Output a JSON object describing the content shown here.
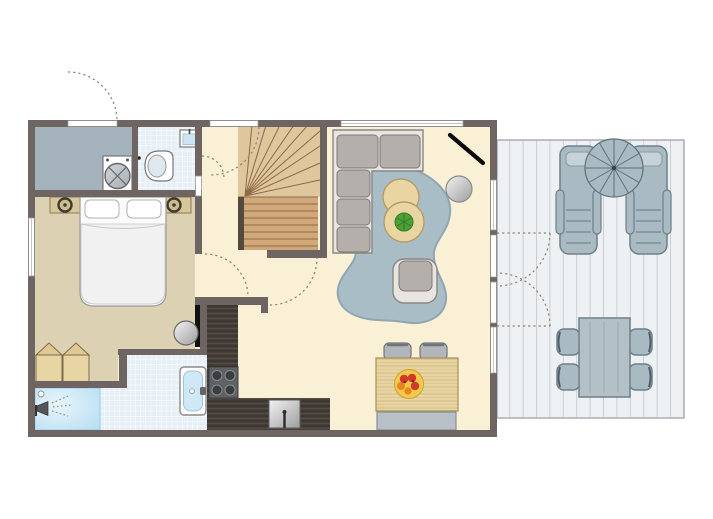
{
  "scene": {
    "type": "floor-plan",
    "width": 713,
    "height": 519
  },
  "colors": {
    "wall": "#6e6461",
    "floor_main": "#faf0d6",
    "floor_bedroom": "#dcd1b2",
    "floor_utility": "#a4b2bc",
    "floor_tile": "#e6eff6",
    "tile_line": "#ffffff",
    "floor_shower_light": "#e8f5fc",
    "floor_shower_dark": "#b4dcf0",
    "stairs_upper": "#e0c69c",
    "stairs_lower": "#d2a87a",
    "stairs_line": "#8b6b47",
    "stairs_stringer": "#52493f",
    "counter": "#47403a",
    "counter_line": "#362f2b",
    "counter_line2": "#57504a",
    "wood_light": "#e7d4a2",
    "wood_line": "#d5bc80",
    "wood_edge": "#a89058",
    "rug": "#a9bdc7",
    "rug_edge": "#8fa6b2",
    "sofa_frame": "#e8e5e1",
    "sofa_cushion": "#b4afab",
    "sofa_edge": "#7d7976",
    "gray_furniture": "#b2b6ba",
    "gray_edge": "#72767a",
    "bench": "#b7c0c7",
    "deck_floor": "#eef1f3",
    "deck_line": "#c9ced3",
    "deck_edge": "#a8aeb4",
    "outdoor_fill": "#a9bac3",
    "outdoor_light": "#c6d2d8",
    "outdoor_edge": "#6e7f88",
    "plant": "#4f9e3a",
    "plant_dark": "#2f7d22",
    "fruit_bowl": "#f3c94a",
    "fruit_red": "#d03a28",
    "fruit_orange": "#e98420",
    "door_arc": "#8c8273",
    "black": "#111111",
    "white": "#ffffff",
    "fixture_edge": "#777777"
  },
  "rooms": [
    {
      "id": "utility-room"
    },
    {
      "id": "toilet-room"
    },
    {
      "id": "bedroom"
    },
    {
      "id": "bathroom"
    },
    {
      "id": "shower"
    },
    {
      "id": "hallway"
    },
    {
      "id": "staircase"
    },
    {
      "id": "kitchen"
    },
    {
      "id": "living-dining-room"
    },
    {
      "id": "terrace-deck"
    }
  ],
  "fixtures": [
    "washing-machine",
    "toilet",
    "hand-basin",
    "double-bed",
    "nightstand-left",
    "nightstand-right",
    "wardrobe",
    "washbasin",
    "mirror-strip",
    "bathtub",
    "shower-head",
    "staircase",
    "kitchen-counter",
    "stove",
    "kitchen-sink",
    "corner-sofa",
    "rug",
    "side-table",
    "side-table-plant",
    "round-mirror-table",
    "tv",
    "armchair",
    "dining-table",
    "dining-chair",
    "dining-chair",
    "dining-bench",
    "fruit-bowl",
    "sun-lounger",
    "sun-lounger",
    "parasol",
    "garden-table",
    "garden-chair",
    "garden-chair",
    "garden-chair",
    "garden-chair"
  ],
  "doors": [
    "front-door",
    "back-door",
    "toilet-door",
    "bedroom-door",
    "living-room-door",
    "terrace-double-door"
  ]
}
